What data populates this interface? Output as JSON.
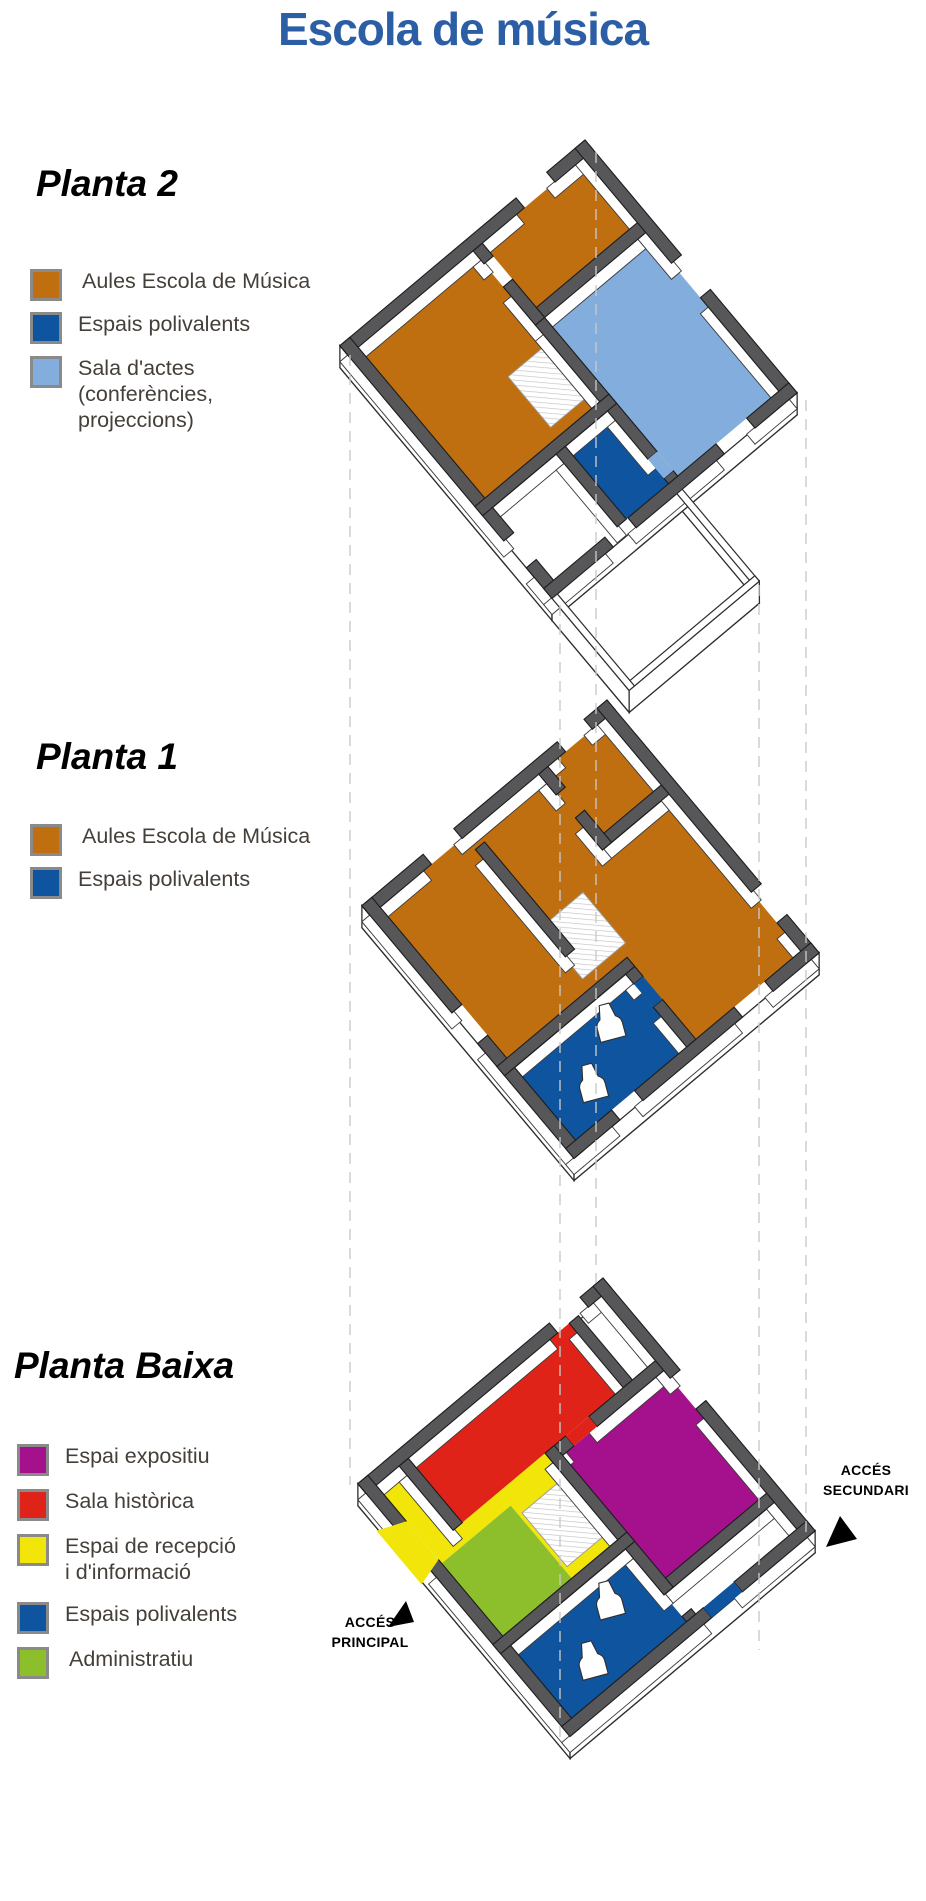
{
  "title": {
    "text": "Escola de música",
    "color": "#2C5EA5"
  },
  "colors": {
    "title": "#2C5EA5",
    "wall": "#57575A",
    "aules": "#C06F10",
    "poliv": "#0F549E",
    "sala": "#82ADDC",
    "expo": "#A5108C",
    "hist": "#E02318",
    "recep": "#F2E50A",
    "admin": "#8DBE2C",
    "dash": "#C9C9C9"
  },
  "floors": [
    {
      "heading": "Planta 2",
      "legend": [
        {
          "key": "aules",
          "label": "Aules Escola de Música",
          "color": "#C06F10"
        },
        {
          "key": "poliv",
          "label": "Espais polivalents",
          "color": "#0F549E"
        },
        {
          "key": "sala",
          "label": "Sala d'actes\n(conferències,\nprojeccions)",
          "color": "#82ADDC"
        }
      ]
    },
    {
      "heading": "Planta 1",
      "legend": [
        {
          "key": "aules",
          "label": "Aules Escola de Música",
          "color": "#C06F10"
        },
        {
          "key": "poliv",
          "label": "Espais polivalents",
          "color": "#0F549E"
        }
      ]
    },
    {
      "heading": "Planta Baixa",
      "legend": [
        {
          "key": "expo",
          "label": "Espai expositiu",
          "color": "#A5108C"
        },
        {
          "key": "hist",
          "label": "Sala històrica",
          "color": "#E02318"
        },
        {
          "key": "recep",
          "label": "Espai de recepció\ni d'informació",
          "color": "#F2E50A"
        },
        {
          "key": "poliv",
          "label": "Espais polivalents",
          "color": "#0F549E"
        },
        {
          "key": "admin",
          "label": "Administratiu",
          "color": "#8DBE2C"
        }
      ],
      "access": [
        {
          "text": "ACCÉS\nSECUNDARI"
        },
        {
          "text": "ACCÉS\nPRINCIPAL"
        }
      ]
    }
  ]
}
